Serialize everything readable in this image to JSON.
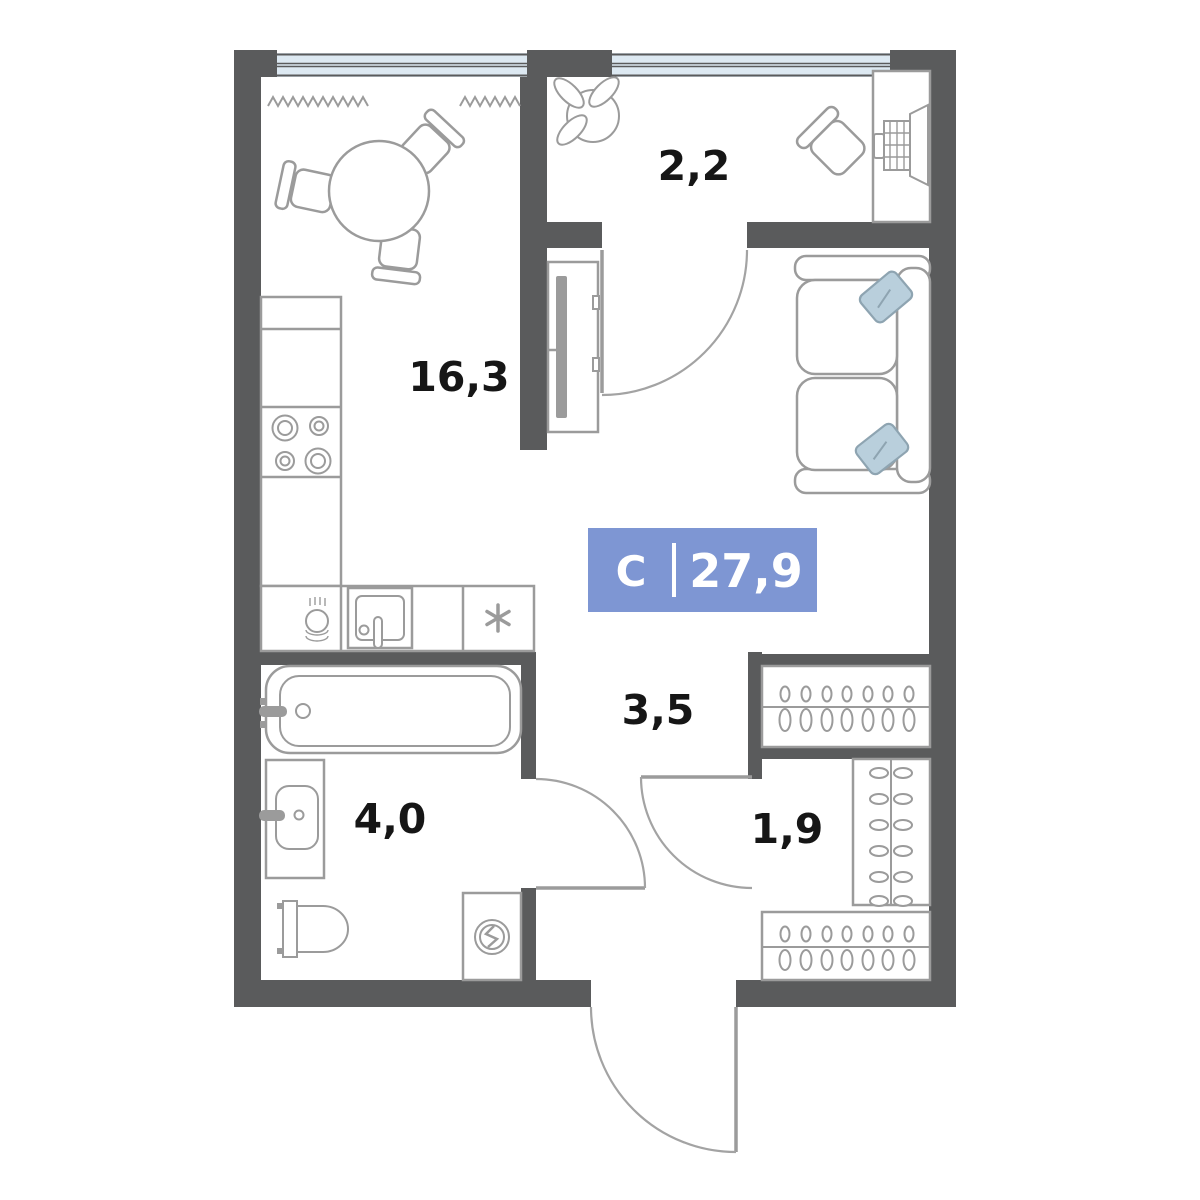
{
  "plan": {
    "type": "studio-apartment-floor-plan"
  },
  "badge": {
    "type_letter": "С",
    "total_area": "27,9"
  },
  "rooms": [
    {
      "name": "kitchen-living-room",
      "area": "16,3"
    },
    {
      "name": "balcony",
      "area": "2,2"
    },
    {
      "name": "hallway",
      "area": "3,5"
    },
    {
      "name": "bathroom",
      "area": "4,0"
    },
    {
      "name": "wardrobe",
      "area": "1,9"
    }
  ],
  "fixtures": [
    "window",
    "radiator-zigzag",
    "dining-table",
    "dining-chair",
    "kitchen-counter",
    "stove-burners",
    "dish-stack",
    "kitchen-sink",
    "refrigerator-asterisk",
    "tv-stand",
    "sofa",
    "pillow",
    "plant",
    "desk",
    "desk-chair",
    "laptop",
    "bathtub",
    "washbasin",
    "toilet",
    "washing-machine",
    "clothes-rail-hangers",
    "door-swing",
    "entrance-door"
  ],
  "colors": {
    "wall": "#5a5b5c",
    "furniture_line": "#9b9b9b",
    "window_fill": "#dde9f2",
    "badge_fill": "#7e96d3",
    "badge_text": "#ffffff",
    "label_text": "#161616",
    "pillow_fill": "#b9cfdc",
    "floor": "#ffffff"
  }
}
